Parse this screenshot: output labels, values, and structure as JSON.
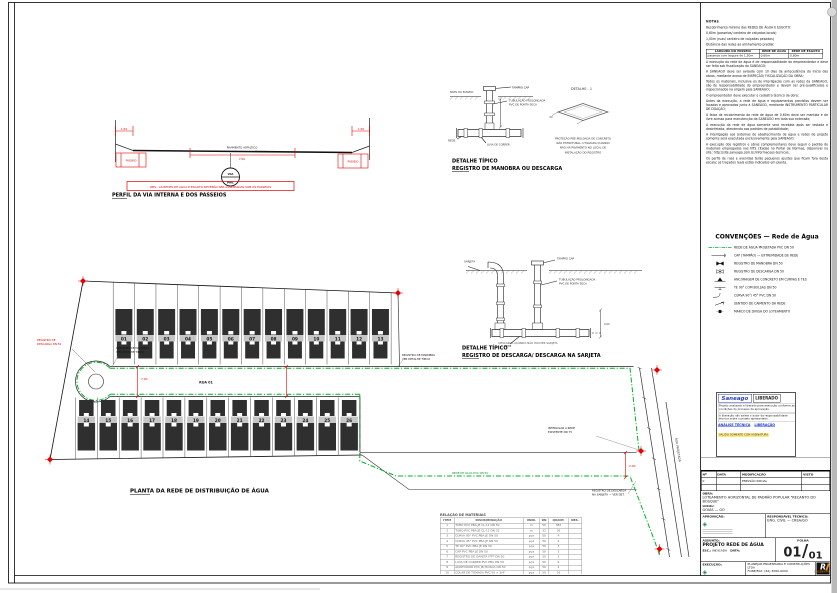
{
  "colors": {
    "green": "#00b12a",
    "red": "#e60000",
    "house": "#2f2f2f"
  },
  "notes": {
    "title": "NOTAS",
    "paragraphs": [
      "Recobrimento mínimo das REDES DE ÁGUA E ESGOTO:",
      "0,60m (passeios/ canteiro de calçadas locais)",
      "1,00m (ruas/ canteiro de calçadas pesadas)",
      "Distância das redes ao alinhamento predial:"
    ],
    "table": {
      "headers": [
        "LARGURA DO PASSEIO",
        "REDE DE ÁGUA",
        "REDE DE ESGOTO"
      ],
      "rows": [
        [
          "passeios com largura de 1,50m",
          "0,60m",
          "0,80m"
        ]
      ]
    },
    "paragraphs2": [
      "A execução da rede de água é de responsabilidade do empreendedor e deve ser feita sob fiscalização da SANEAGO;",
      "A SANEAGO deve ser avisada com 10 dias de antecedência do início das obras, mediante anexo de INSPEÇÃO/ FISCALIZAÇÃO DA OBRA;",
      "Todos os materiais, inclusive os de interligação com as redes da SANEAGO, são de responsabilidade do empreendedor e devem ser pré-qualificados e inspecionados na origem pela SANEAGO;",
      "O empreendedor deve executar o cadastro técnico da obra;",
      "Antes da execução, a rede de água e equipamentos previstos devem ser locados e aprovados junto à SANEAGO, mediante INSTRUMENTO PARTICULAR DE DOAÇÃO;",
      "A faixa de recobrimento da rede de água de 0,60m deve ser mantida e de livre acesso para manutenção da SANEAGO em toda sua extensão;",
      "A execução da rede de água somente será recebida após ser testada e desinfetada, atendendo aos padrões de potabilidade;",
      "A interligação aos sistemas de abastecimento de água e redes de projeto somente será executada exclusivamente pela SANEAGO;",
      "A execução dos registros e obras complementares deve seguir o padrão de materiais empregados nas NTS citadas no Portal de Normas, disponível no site: http://site.saneago.com.br/informacoes-tecnicas.",
      "Os perfis de ruas e avenidas terão pequenos ajustes que ficam fora desta escala; os traçados reais estão indicados em planta."
    ]
  },
  "legend": {
    "title": "CONVENÇÕES — Rede de Água",
    "items": [
      {
        "symbol": "water-line",
        "label": "REDE DE ÁGUA PROJETADA PVC DN 50"
      },
      {
        "symbol": "cap",
        "label": "CAP (TAMPÃO) — EXTREMIDADE DE REDE"
      },
      {
        "symbol": "valve",
        "label": "REGISTRO DE MANOBRA DN 50"
      },
      {
        "symbol": "discharge",
        "label": "REGISTRO DE DESCARGA DN 50"
      },
      {
        "symbol": "anchor",
        "label": "ANCORAGEM DE CONCRETO EM CURVAS E TES"
      },
      {
        "symbol": "tee",
        "label": "TE 90° COM BOLSAS DN 50"
      },
      {
        "symbol": "curve",
        "label": "CURVA 90°/ 45° PVC DN 50"
      },
      {
        "symbol": "flow",
        "label": "SENTIDO DE CAIMENTO DA REDE"
      },
      {
        "symbol": "mark",
        "label": "MARCO DE DIVISA DO LOTEAMENTO"
      }
    ]
  },
  "stamp": {
    "logo": "Saneago",
    "status": "LIBERADO",
    "body": [
      "Projeto analisado e liberado para execução conforme as condições do processo de aprovação.",
      "A liberação não exime o autor da responsabilidade técnica sobre o projeto apresentado."
    ],
    "link1": "ANÁLISE TÉCNICA",
    "link2": "LIBERAÇÃO",
    "note": "VÁLIDO SOMENTE COM ASSINATURA"
  },
  "titleblock": {
    "rev_headers": [
      "Nº",
      "DATA",
      "MODIFICAÇÃO",
      "VISTO"
    ],
    "rev_rows": [
      [
        "0",
        "",
        "EMISSÃO INICIAL",
        ""
      ],
      [
        "",
        "",
        "",
        ""
      ]
    ],
    "obra_label": "OBRA:",
    "obra": "LOTEAMENTO HORIZONTAL DE PADRÃO POPULAR \"RECANTO DO BOSQUE\"",
    "local_label": "LOCAL:",
    "local": "GOIÁS — GO",
    "aprov_label": "APROVAÇÃO:",
    "resp_label": "RESPONSÁVEL TÉCNICO:",
    "resp": "ENG. CIVIL — CREA/GO",
    "assunto_label": "ASSUNTO:",
    "assunto": "PROJETO REDE DE ÁGUA",
    "esc_label": "ESC.:",
    "esc": "INDICADA",
    "data_label": "DATA:",
    "folha_label": "FOLHA",
    "folha_num": "01",
    "folha_den": "01",
    "exec_label": "EXECUÇÃO:",
    "empresa": "PLANEJAR ENGENHARIA E CONSTRUÇÕES LTDA",
    "empresa2": "FONE/FAX: (62) 3000-0000",
    "logo_letter": "R",
    "logo_sub": "ENGENHARIA"
  },
  "plan": {
    "title": "PLANTA DA REDE DE DISTRIBUIÇÃO DE ÁGUA",
    "top_lots": [
      "01",
      "02",
      "03",
      "04",
      "05",
      "06",
      "07",
      "08",
      "09",
      "10",
      "11",
      "12",
      "13"
    ],
    "bottom_lots": [
      "14",
      "15",
      "16",
      "17",
      "18",
      "19",
      "20",
      "21",
      "22",
      "23",
      "24",
      "25",
      "26"
    ],
    "street_label": "RUA 01",
    "road_label": "RUA PROJETADA",
    "rede_label": "REDE DE ÁGUA PVC DN 50",
    "dim_street": "7,00",
    "dim_right": "2,00",
    "ann_loop_black": [
      "REGISTRO DE MANOBRA",
      "VER DETALHE TÍPICO"
    ],
    "ann_loop_red": [
      "REGISTRO DE",
      "DESCARGA DN 50"
    ],
    "ann_right_top": [
      "REGISTRO DE MANOBRA",
      "VER DETALHE TÍPICO"
    ],
    "ann_tiein": [
      "INTERLIGAR À REDE",
      "EXISTENTE DN 75"
    ],
    "ann_discharge": [
      "REGISTRO DE DESCARGA",
      "NA SARJETA — VER DET."
    ]
  },
  "profile": {
    "title": "PERFIL DA VIA INTERNA E DOS PASSEIOS",
    "left_walk": "PASSEIO",
    "left_dim": "1,50",
    "right_walk": "PASSEIO",
    "right_dim": "1,50",
    "road_text": "PAVIMENTO ASFÁLTICO",
    "road_dim": "7,00",
    "bubble_top": "VIA",
    "bubble_bottom": "PAV.",
    "note": "OBS.: AS REDES DE ÁGUA E ESGOTO DEVERÃO SER ASSENTADAS SOB OS PASSEIOS"
  },
  "detail1": {
    "title1": "DETALHE TÍPICO",
    "title2": "REGISTRO DE MANOBRA OU DESCARGA",
    "cap": "TAMPÃO CAP",
    "ground": "NÍVEL DO PASSEIO",
    "pipe": [
      "TUBULAÇÃO PROLONGADA",
      "PVC DE PONTA SECA"
    ],
    "rede": "REDE",
    "luva": "LUVA DE CORRER",
    "det_ref": "DETALHE - 1",
    "dim": "60",
    "note": [
      "PROTEÇÃO PRÉ-MOLDADA DE CONCRETO",
      "NÃO ESTRUTURAL, UTILIZADA QUANDO",
      "NÃO HÁ PAVIMENTO NO LOCAL DE",
      "INSTALAÇÃO DO REGISTRO"
    ]
  },
  "detail2": {
    "title1": "DETALHE TÍPICO",
    "title2": "REGISTRO DE DESCARGA/ DESCARGA NA SARJETA",
    "sarjeta": "SARJETA",
    "cap": "TAMPÃO CAP",
    "pipe": [
      "TUBULAÇÃO PROLONGADA",
      "PVC DE PONTA SECA"
    ],
    "rede": "REDE",
    "dim": "0,60",
    "caption": "DESCARGA QUANDO NÃO HOUVER SARJETA"
  },
  "materials": {
    "title": "RELAÇÃO DE MATERIAIS",
    "headers": [
      "ITEM",
      "DISCRIMINAÇÃO",
      "UNID.",
      "DN",
      "QUANT.",
      "OBS."
    ],
    "rows": [
      [
        "1",
        "TUBO PVC PBA JE CL-12 DN 50",
        "m",
        "50",
        "382",
        ""
      ],
      [
        "2",
        "TUBO PVC PBA JE CL-12 DN 32",
        "m",
        "32",
        "36",
        ""
      ],
      [
        "3",
        "CURVA 90° PVC PBA JE DN 50",
        "pça",
        "50",
        "4",
        ""
      ],
      [
        "4",
        "CURVA 45° PVC PBA JE DN 50",
        "pça",
        "50",
        "2",
        ""
      ],
      [
        "5",
        "TE 90° PVC PBA JE DN 50",
        "pça",
        "50",
        "3",
        ""
      ],
      [
        "6",
        "CAP PVC PBA JE DN 50",
        "pça",
        "50",
        "3",
        ""
      ],
      [
        "7",
        "REGISTRO DE GAVETA FºFº DN 50",
        "pça",
        "50",
        "2",
        ""
      ],
      [
        "8",
        "LUVA DE CORRER PVC PBA DN 50",
        "pça",
        "50",
        "6",
        ""
      ],
      [
        "9",
        "ADAPTADOR PVC JE/ ROSCA DN 50",
        "pça",
        "50",
        "2",
        ""
      ],
      [
        "10",
        "COLAR DE TOMADA PVC 50 × 3/4\"",
        "pça",
        "50",
        "26",
        ""
      ]
    ]
  }
}
